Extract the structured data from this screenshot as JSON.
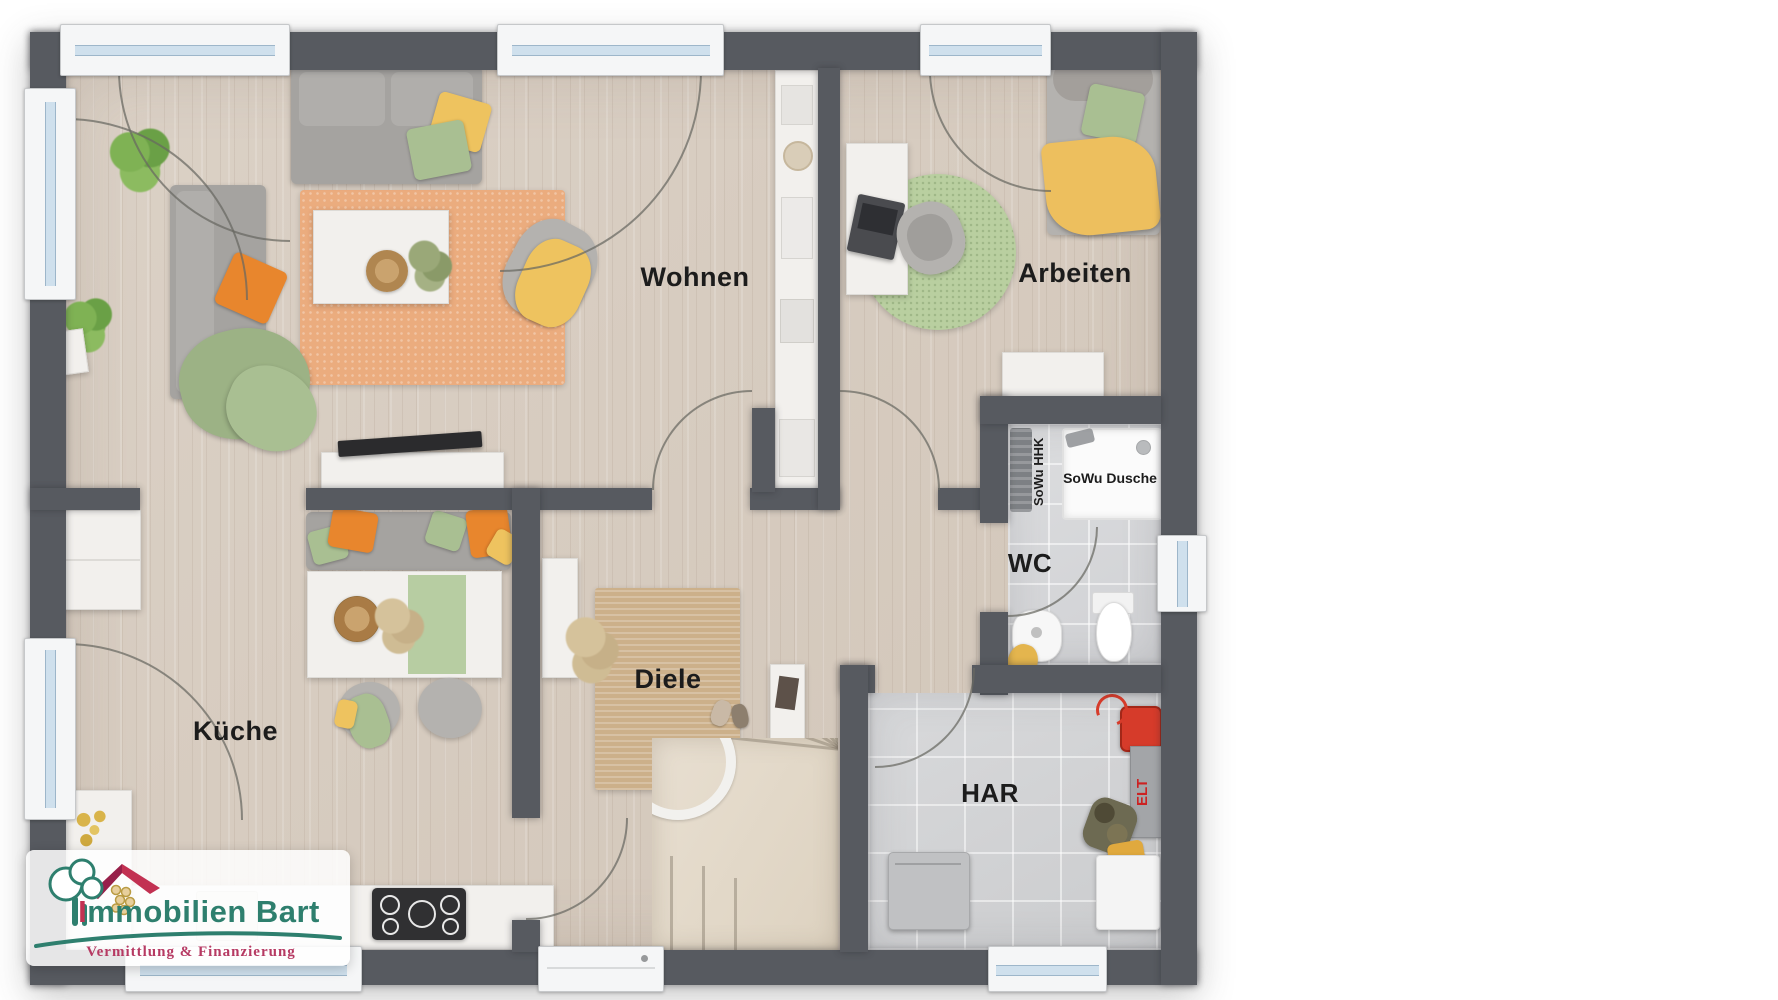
{
  "floor_plan": {
    "rooms": [
      {
        "id": "wohnen",
        "label": "Wohnen"
      },
      {
        "id": "arbeiten",
        "label": "Arbeiten"
      },
      {
        "id": "kueche",
        "label": "Küche"
      },
      {
        "id": "diele",
        "label": "Diele"
      },
      {
        "id": "wc",
        "label": "WC"
      },
      {
        "id": "har",
        "label": "HAR"
      }
    ],
    "annotations": {
      "shower": "SoWu Dusche",
      "towel_radiator": "SoWu HHK",
      "electrical": "ELT"
    }
  },
  "logo": {
    "title": "Immobilien Bart",
    "subtitle": "Vermittlung & Finanzierung"
  },
  "colors": {
    "wall": "#575a60",
    "wood_floor": "#d8cdc1",
    "tile_floor": "#d8d9db",
    "rug_orange": "#ebac7e",
    "rug_jute": "#ccb08a",
    "rug_green": "#b9cfa0",
    "accent_orange": "#e8862d",
    "accent_yellow": "#eec35f",
    "accent_green": "#a9bf92",
    "logo_teal": "#2e7f6e",
    "logo_red": "#b63a63",
    "elt_red": "#cc2222"
  }
}
